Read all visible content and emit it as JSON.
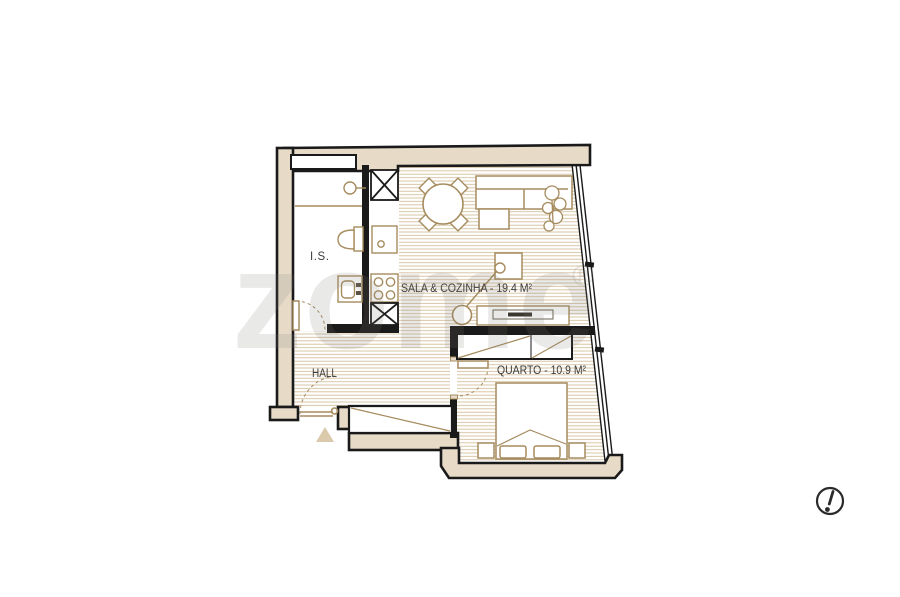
{
  "floorplan": {
    "rooms": {
      "bathroom": {
        "label": "I.S."
      },
      "living_kitchen": {
        "label": "SALA & COZINHA - 19.4 M²",
        "area_m2": 19.4
      },
      "hall": {
        "label": "HALL"
      },
      "bedroom": {
        "label": "QUARTO - 10.9 M²",
        "area_m2": 10.9
      }
    },
    "watermark": {
      "text": "zome",
      "registered_mark": "®"
    },
    "icons": [
      "alert-exclamation-icon",
      "shower-icon",
      "toilet-icon",
      "washbasin-icon",
      "stove-icon",
      "sink-icon",
      "fridge-icon",
      "entrance-triangle-icon"
    ],
    "colors": {
      "background": "#ffffff",
      "wall_fill": "#e7dbc8",
      "wall_outline": "#1a1a1a",
      "floor_stripe": "#c9ae82",
      "furniture_line": "#a68c5f",
      "label_text": "#3b3b3b"
    }
  }
}
